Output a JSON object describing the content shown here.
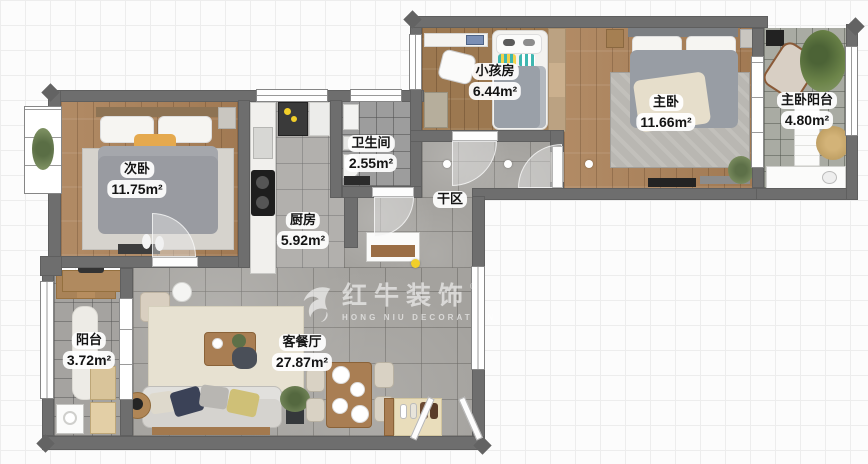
{
  "plan": {
    "rooms": {
      "ciwo": {
        "name": "次卧",
        "area": "11.75m²"
      },
      "chufang": {
        "name": "厨房",
        "area": "5.92m²"
      },
      "weishengjian": {
        "name": "卫生间",
        "area": "2.55m²"
      },
      "ganqu": {
        "name": "干区"
      },
      "xiaohaifang": {
        "name": "小孩房",
        "area": "6.44m²"
      },
      "zhuwo": {
        "name": "主卧",
        "area": "11.66m²"
      },
      "zhuwoyangtai": {
        "name": "主卧阳台",
        "area": "4.80m²"
      },
      "yangtai": {
        "name": "阳台",
        "area": "3.72m²"
      },
      "keting": {
        "name": "客餐厅",
        "area": "27.87m²"
      }
    },
    "watermark": {
      "brand": "红牛装饰",
      "brand_en": "HONG NIU DECORATION",
      "registered": "®"
    },
    "colors": {
      "wall": "#6e6e6e",
      "tile": "#a4a29e",
      "wood": "#ab8158",
      "accent_yellow": "#f2cf2a"
    }
  }
}
